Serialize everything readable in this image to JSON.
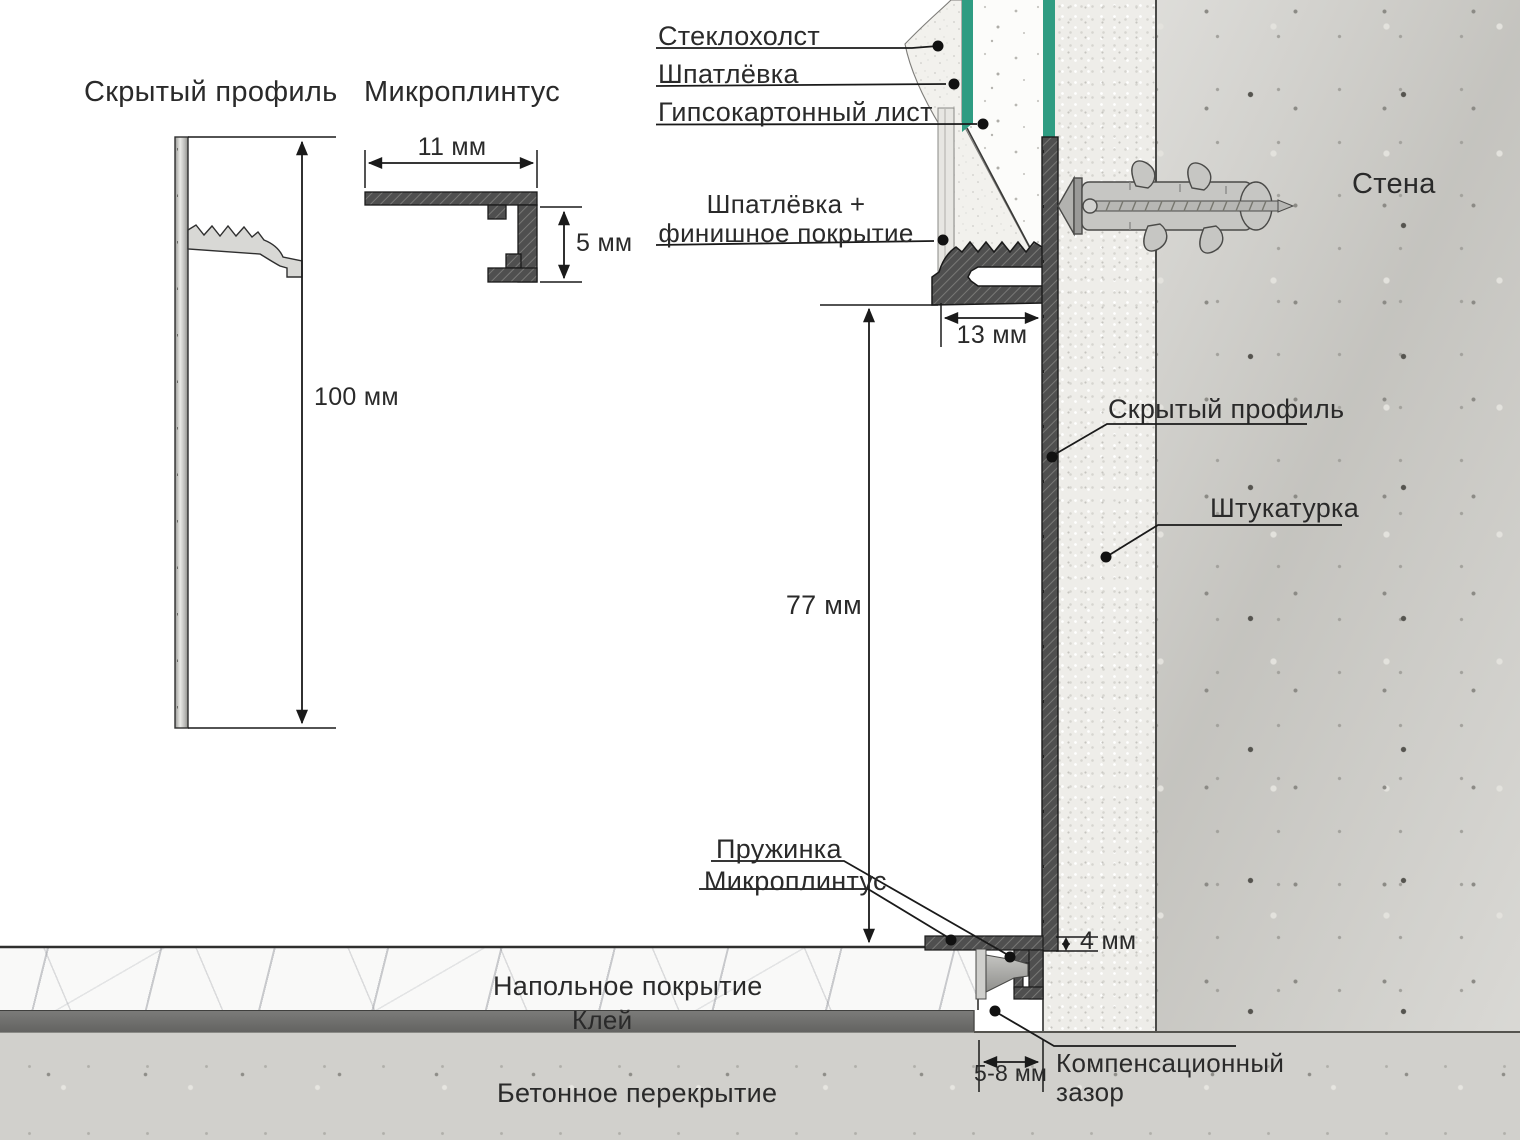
{
  "colors": {
    "ink": "#2a2a2a",
    "line": "#1a1a1a",
    "green": "#2f9c82",
    "profile_dark": "#4f4f4f",
    "profile_hatch": "#787876",
    "glue": "#6e6e6c",
    "wall_base": "#cfcec9",
    "plaster_base": "#eeede9",
    "slab_base": "#d1d0cc",
    "floor_base": "#f9f9f8"
  },
  "left_profile_drawing": {
    "title": "Скрытый профиль",
    "height_dim": "100 мм"
  },
  "micro_skirting_drawing": {
    "title": "Микроплинтус",
    "width_dim": "11 мм",
    "height_dim": "5 мм"
  },
  "section_labels": {
    "glass_fiber": "Стеклохолст",
    "putty": "Шпатлёвка",
    "drywall_sheet": "Гипсокартонный лист",
    "putty_finish_line1": "Шпатлёвка +",
    "putty_finish_line2": "финишное покрытие",
    "wall": "Стена",
    "hidden_profile": "Скрытый профиль",
    "plaster": "Штукатурка",
    "spring": "Пружинка",
    "micro_skirting": "Микроплинтус",
    "floor_covering": "Напольное покрытие",
    "glue": "Клей",
    "concrete_slab": "Бетонное перекрытие",
    "compensation_gap_line1": "Компенсационный",
    "compensation_gap_line2": "зазор"
  },
  "dimensions": {
    "profile_offset": "13 мм",
    "profile_height": "77 мм",
    "skirting_reveal": "4 мм",
    "expansion_gap": "5-8 мм"
  }
}
